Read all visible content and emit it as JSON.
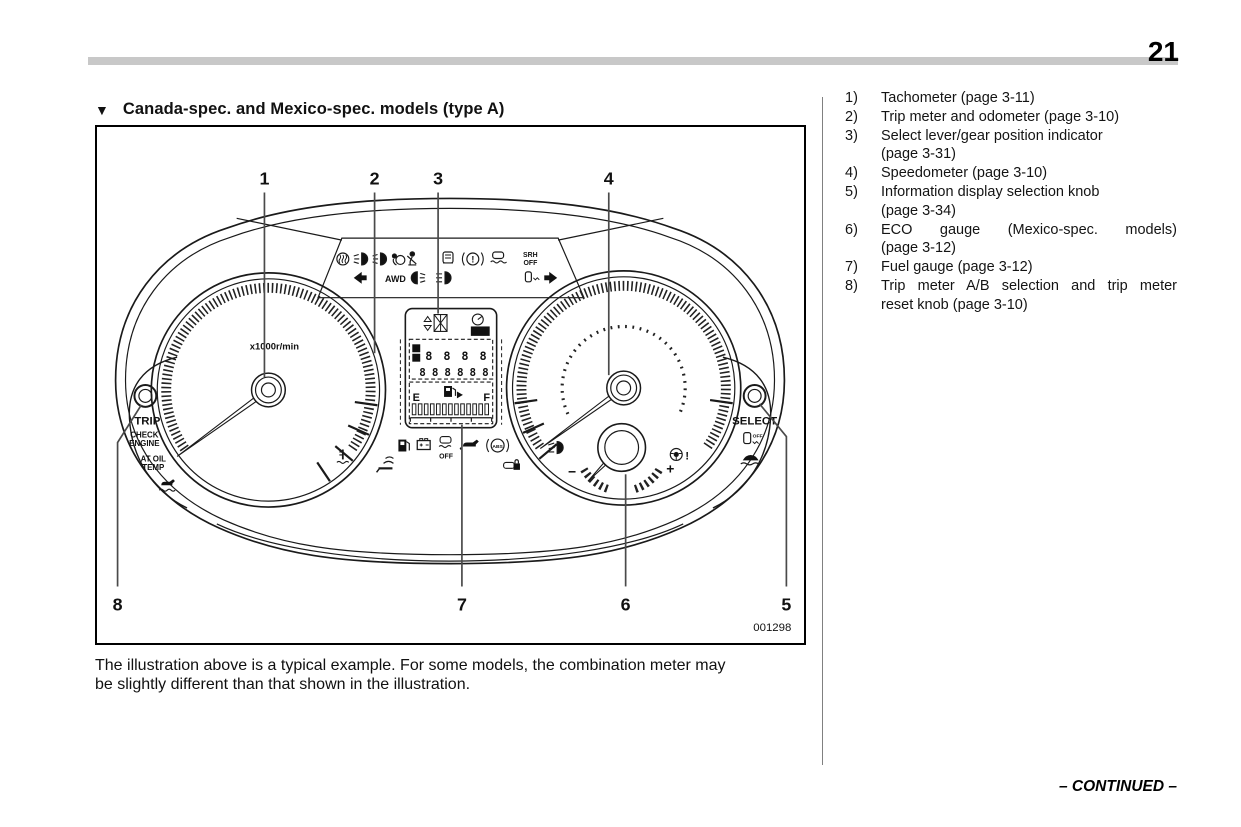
{
  "page": {
    "number": "21",
    "continued": "– CONTINUED –"
  },
  "heading": {
    "marker": "▼",
    "title": "Canada-spec. and Mexico-spec. models (type A)"
  },
  "figure": {
    "code": "001298",
    "callouts": [
      "1",
      "2",
      "3",
      "4",
      "5",
      "6",
      "7",
      "8"
    ],
    "labels": {
      "tach_unit": "x1000r/min",
      "trip": "TRIP",
      "check": "CHECK",
      "engine": "ENGINE",
      "at_oil": "AT OIL",
      "temp": "TEMP",
      "select": "SELECT",
      "awd": "AWD",
      "srh": "SRH",
      "srh_off": "OFF",
      "vdc_off": "OFF",
      "abs": "ABS",
      "set": "SET",
      "key_off": "OFF",
      "fuel_empty": "E",
      "fuel_full": "F",
      "trip_a": "A",
      "trip_b": "B",
      "trip_digits": "8888",
      "odo_digits": "888888",
      "eco_minus": "−",
      "eco_plus": "+",
      "steer_excl": "!",
      "brake_excl": "!"
    },
    "icons": [
      "defrost-icon",
      "fog-light-icon",
      "headlight-icon",
      "airbag-icon",
      "seatbelt-icon",
      "seat-icon",
      "brake-warning-icon",
      "vdc-icon",
      "turn-left-icon",
      "rear-fog-icon",
      "high-beam-icon",
      "keyless-icon",
      "turn-right-icon",
      "fuel-pump-icon",
      "battery-icon",
      "vdc-off-icon",
      "oil-pressure-icon",
      "abs-icon",
      "security-icon",
      "keyless-signal-icon",
      "coolant-temp-icon",
      "oil-temp-icon",
      "headlight-leveling-icon",
      "steering-warning-icon",
      "trailer-sway-icon",
      "key-off-icon",
      "gear-position-icon",
      "cruise-set-icon"
    ]
  },
  "caption": {
    "line1": "The illustration above is a typical example. For some models, the combination meter may",
    "line2": "be slightly different than that shown in the illustration."
  },
  "legend": {
    "items": [
      {
        "num": "1)",
        "lines": [
          "Tachometer (page 3-11)"
        ]
      },
      {
        "num": "2)",
        "lines": [
          "Trip meter and odometer (page 3-10)"
        ]
      },
      {
        "num": "3)",
        "lines": [
          "Select lever/gear position indicator",
          "(page 3-31)"
        ]
      },
      {
        "num": "4)",
        "lines": [
          "Speedometer (page 3-10)"
        ]
      },
      {
        "num": "5)",
        "lines": [
          "Information display selection knob",
          "(page 3-34)"
        ]
      },
      {
        "num": "6)",
        "lines": [
          "ECO gauge (Mexico-spec. models)",
          "(page 3-12)"
        ],
        "justify_first": true
      },
      {
        "num": "7)",
        "lines": [
          "Fuel gauge (page 3-12)"
        ]
      },
      {
        "num": "8)",
        "lines": [
          "Trip meter A/B selection and trip meter",
          "reset knob (page 3-10)"
        ],
        "justify_first": true
      }
    ]
  }
}
